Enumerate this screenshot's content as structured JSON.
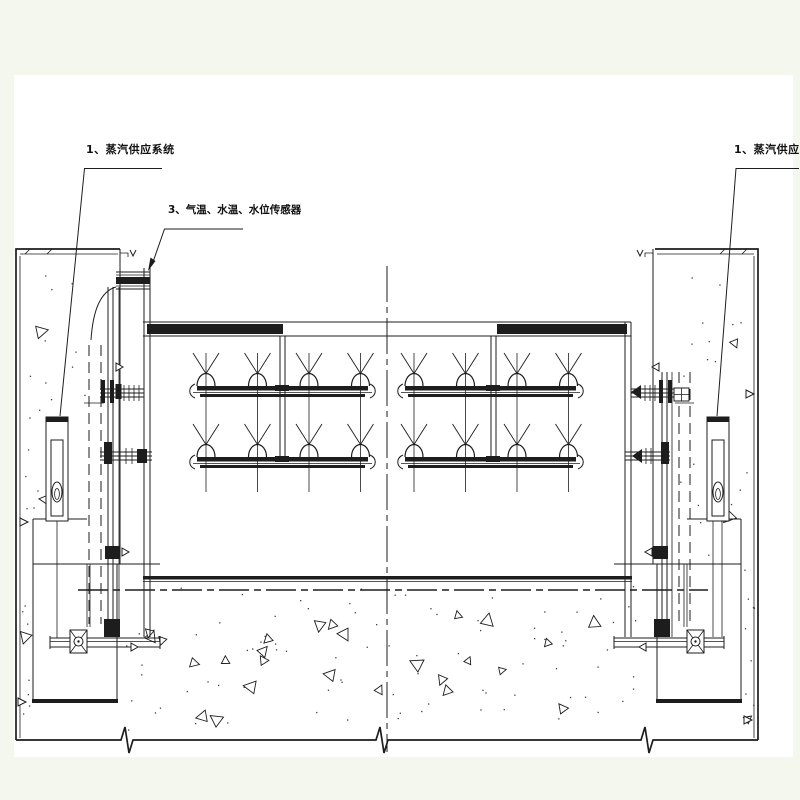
{
  "page": {
    "background_color": "#f4f7ee",
    "paper_color": "#ffffff",
    "line_color": "#1d1d1d",
    "title": "equipment section drawing"
  },
  "labels": {
    "steam_supply_left": "1、蒸汽供应系统",
    "sensors": "3、气温、水温、水位传感器",
    "steam_supply_right": "1、蒸汽供应系统"
  }
}
